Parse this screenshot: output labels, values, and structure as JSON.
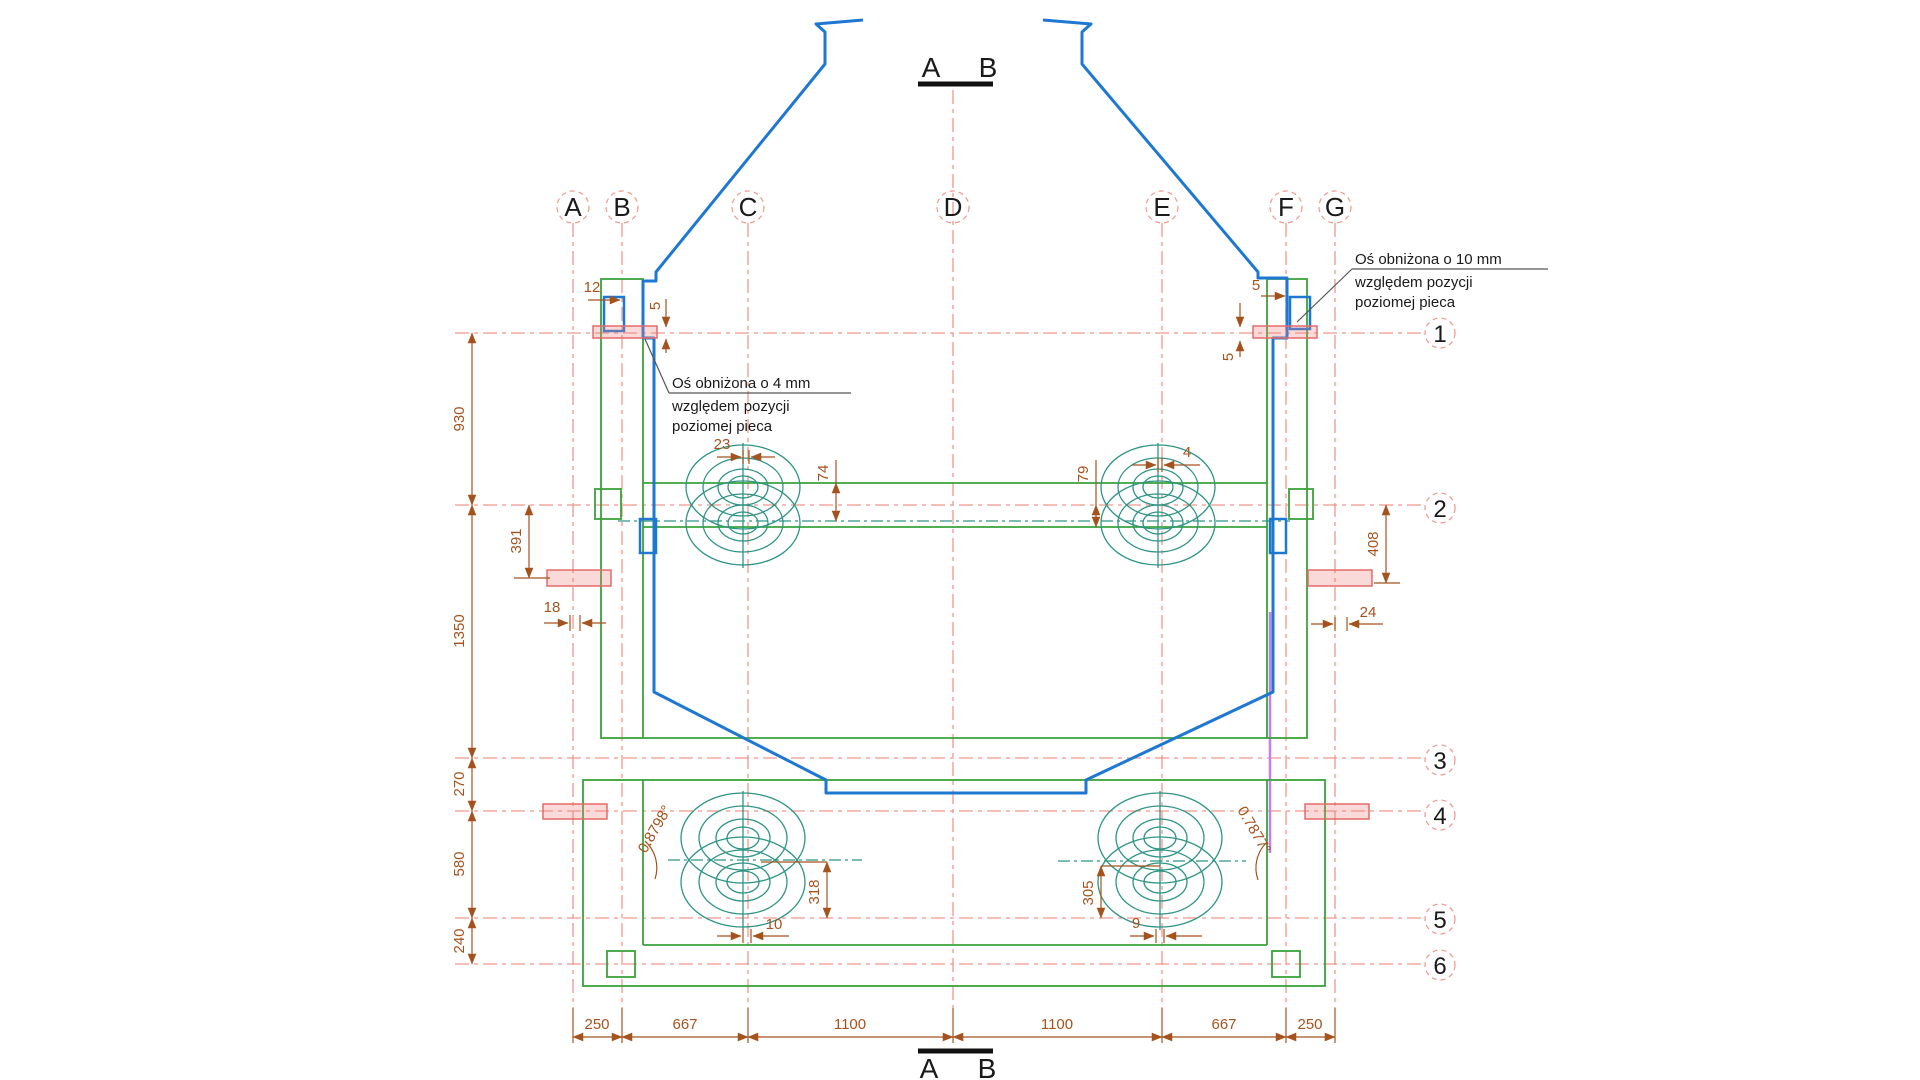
{
  "drawing_type": "furnace cross-section technical drawing",
  "colors": {
    "hopper_blue": "#1e78d2",
    "frame_green": "#3aa23a",
    "roller_teal": "#2e9484",
    "centerline_red": "#f0978c",
    "dimension_brown": "#a5531e",
    "highlight_pink": "#e36b6b",
    "axis_magenta": "#c77df0",
    "text_black": "#1a1a1a"
  },
  "section_markers": {
    "top": {
      "a": "A",
      "b": "B"
    },
    "bottom": {
      "a": "A",
      "b": "B"
    }
  },
  "axes": {
    "columns": [
      "A",
      "B",
      "C",
      "D",
      "E",
      "F",
      "G"
    ],
    "rows": [
      "1",
      "2",
      "3",
      "4",
      "5",
      "6"
    ]
  },
  "annotations": {
    "axis_lowered_10": {
      "line1": "Oś obniżona o 10 mm",
      "line2": "względem pozycji",
      "line3": "poziomej pieca"
    },
    "axis_lowered_4": {
      "line1": "Oś obniżona o 4 mm",
      "line2": "względem pozycji",
      "line3": "poziomej pieca"
    }
  },
  "dimensions": {
    "top_left_pin_width": "12",
    "top_left_axis_drop": "5",
    "top_right_pin_width": "5",
    "top_right_axis_drop": "5",
    "left_chain": [
      "930",
      "1350",
      "270",
      "580",
      "240"
    ],
    "left_bearing_offset": "391",
    "left_frame_offset": "18",
    "right_bearing_offset": "408",
    "right_frame_offset": "24",
    "upper_left_roller_offset": "23",
    "upper_left_roller_drop": "74",
    "upper_right_roller_drop": "79",
    "upper_right_roller_offset": "4",
    "lower_left_roller_angle": "0.8798°",
    "lower_left_roller_height": "318",
    "lower_left_roller_offset": "10",
    "lower_right_roller_angle": "0.7877°",
    "lower_right_roller_height": "305",
    "lower_right_roller_offset": "9",
    "bottom_chain": [
      "250",
      "667",
      "1100",
      "1100",
      "667",
      "250"
    ]
  }
}
